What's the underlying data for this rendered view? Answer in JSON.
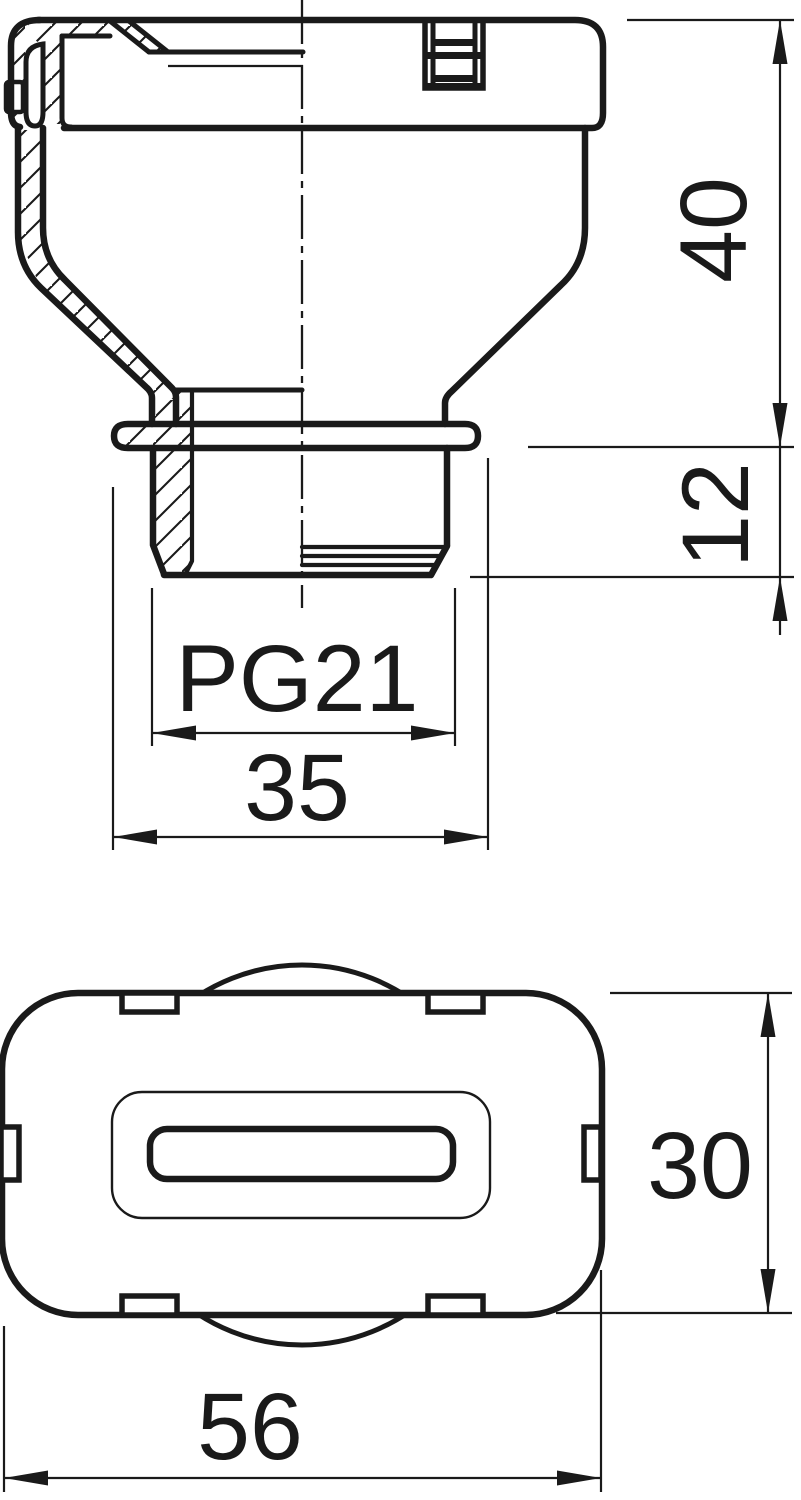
{
  "drawing": {
    "title": "cable-gland-cover-technical-drawing",
    "line_color": "#1a1a1a",
    "background_color": "#ffffff",
    "views": {
      "section": {
        "name": "front-section-view",
        "dims": [
          {
            "id": "upper-body-height",
            "label": "40"
          },
          {
            "id": "thread-length",
            "label": "12"
          },
          {
            "id": "thread-designation",
            "label": "PG21"
          },
          {
            "id": "flange-width",
            "label": "35"
          }
        ]
      },
      "plan": {
        "name": "plan-view",
        "dims": [
          {
            "id": "body-depth",
            "label": "30"
          },
          {
            "id": "body-width",
            "label": "56"
          }
        ]
      }
    }
  }
}
